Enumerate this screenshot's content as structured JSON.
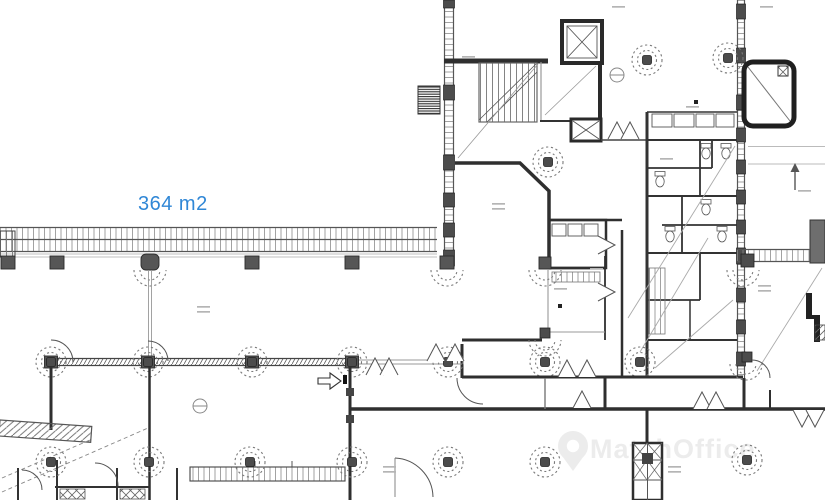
{
  "plan": {
    "area_label": "364 m2",
    "area_label_color": "#3087d6"
  },
  "watermark": {
    "text": "MatchOffice",
    "color": "#ececec",
    "logo_icon": "map-pin-icon"
  },
  "palette": {
    "wall": "#333333",
    "light_line": "#999999",
    "column_fill": "#4c4c4c",
    "tick": "#8a8a8a"
  }
}
